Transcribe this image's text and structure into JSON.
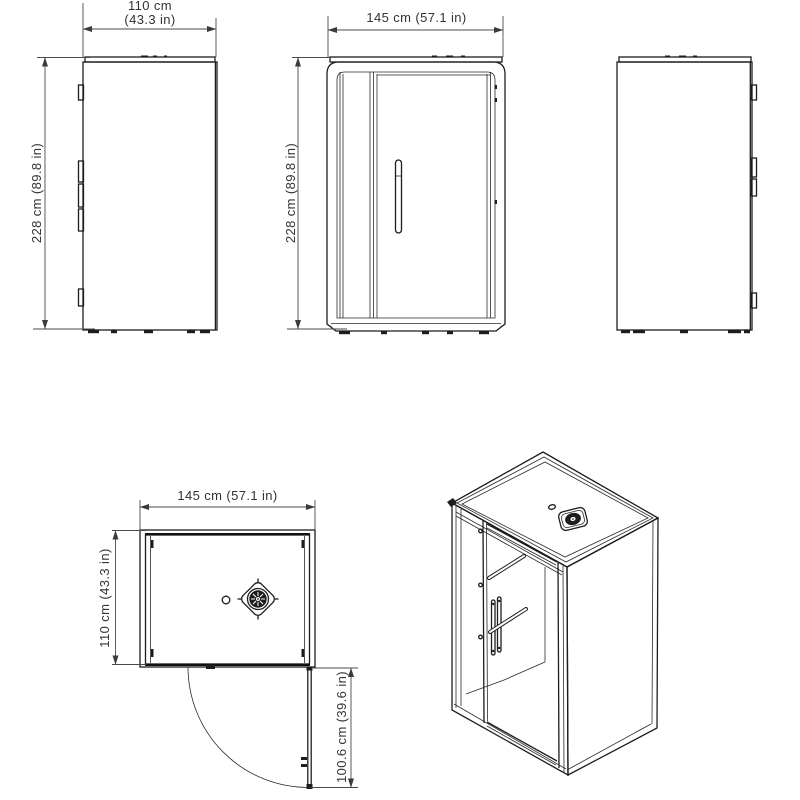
{
  "colors": {
    "background": "#ffffff",
    "line": "#1d1d1d",
    "dimension_line": "#4a4a4a",
    "text": "#333333"
  },
  "icons": {
    "fan_top_view": "fan-vent-icon",
    "fan_isometric": "fan-vent-icon",
    "door_swing": "quarter-arc-door-swing"
  },
  "dimensions": {
    "width": "145 cm (57.1 in)",
    "depth": "110 cm (43.3 in)",
    "height": "228 cm (89.8 in)",
    "door_clearance": "100.6 cm (39.6 in)"
  },
  "labels": {
    "side_left_width_line1": "110 cm",
    "side_left_width_line2": "(43.3 in)",
    "side_left_height": "228 cm (89.8 in)",
    "front_width": "145 cm (57.1 in)",
    "front_height": "228 cm (89.8 in)",
    "top_width": "145 cm (57.1 in)",
    "top_depth": "110 cm (43.3 in)",
    "top_door_swing": "100.6 cm (39.6 in)"
  }
}
